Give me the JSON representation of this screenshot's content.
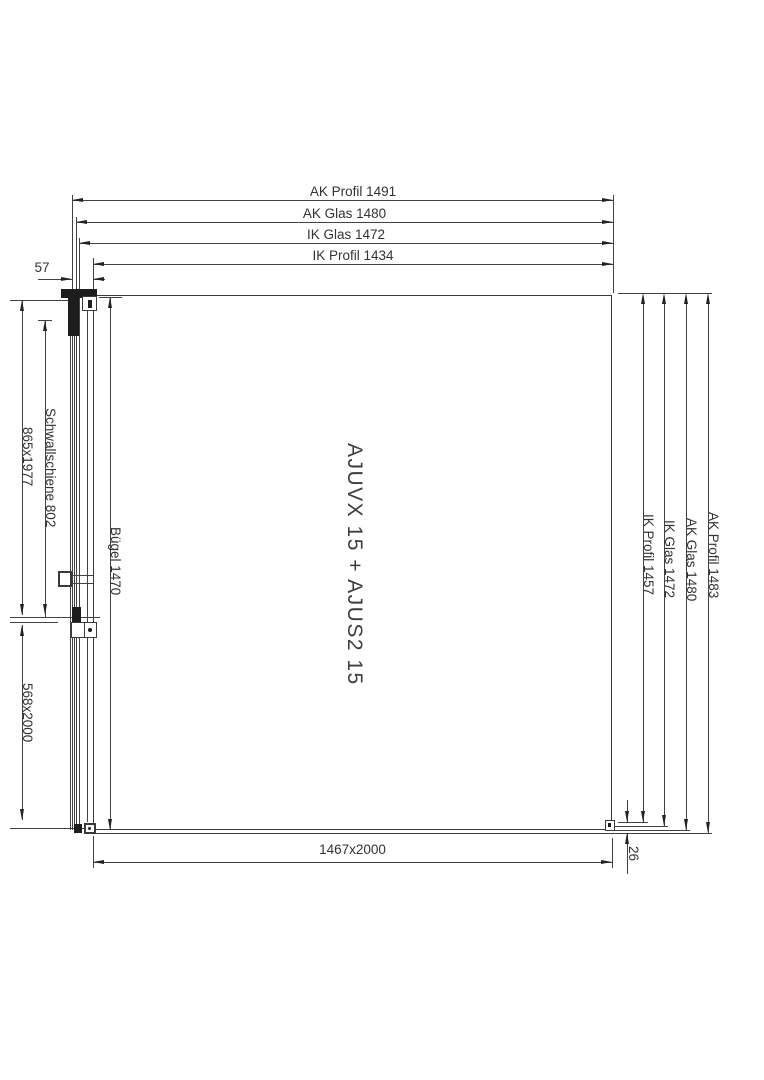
{
  "panel": {
    "label": "AJUVX 15 + AJUS2 15"
  },
  "dims": {
    "top": [
      {
        "label": "AK Profil 1491"
      },
      {
        "label": "AK Glas 1480"
      },
      {
        "label": "IK Glas 1472"
      },
      {
        "label": "IK Profil 1434"
      }
    ],
    "left": [
      {
        "label": "57"
      },
      {
        "label": "865x1977"
      },
      {
        "label": "Schwallschiene 802"
      },
      {
        "label": "Bügel 1470"
      },
      {
        "label": "568x2000"
      }
    ],
    "right": [
      {
        "label": "IK Profil 1457"
      },
      {
        "label": "IK Glas 1472"
      },
      {
        "label": "AK Glas 1480"
      },
      {
        "label": "AK Profil 1483"
      }
    ],
    "bottom": [
      {
        "label": "1467x2000"
      },
      {
        "label": "26"
      }
    ]
  },
  "colors": {
    "line": "#424242",
    "dark": "#1d1d1d",
    "background": "#ffffff"
  }
}
